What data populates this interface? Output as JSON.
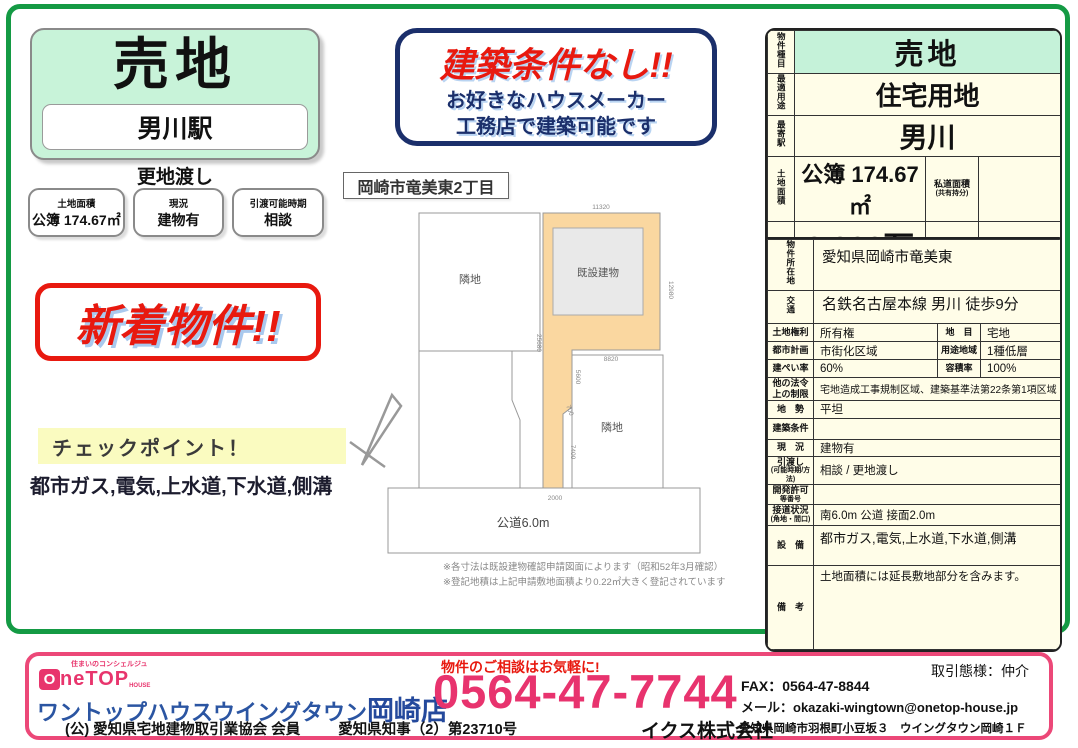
{
  "left_panel": {
    "title": "売地",
    "station": "男川駅",
    "delivery_note": "更地渡し",
    "info_boxes": [
      {
        "label": "土地面積",
        "value": "公簿 174.67㎡"
      },
      {
        "label": "現況",
        "value": "建物有"
      },
      {
        "label": "引渡可能時期",
        "value": "相談"
      }
    ],
    "new_badge": "新着物件!!",
    "checkpoint_title": "チェックポイント！",
    "checkpoint_text": "都市ガス,電気,上水道,下水道,側溝"
  },
  "banner": {
    "headline": "建築条件なし!!",
    "sub1": "お好きなハウスメーカー",
    "sub2": "工務店で建築可能です"
  },
  "site_plan": {
    "title": "岡崎市竜美東2丁目",
    "neighbor_left": "隣地",
    "neighbor_right": "隣地",
    "building": "既設建物",
    "road": "公道6.0m",
    "dim_top": "11320",
    "dim_right": "12980",
    "dim_left": "25680",
    "dim_mid": "8820",
    "dim_inner": "5600",
    "dim_jog": "700",
    "dim_lower": "7400",
    "dim_bottom": "2000",
    "note1": "※各寸法は既設建物確認申請図面によります（昭和52年3月確認）",
    "note2": "※登記地積は上記申請敷地面積より0.22㎡大きく登記されています"
  },
  "summary": {
    "type_label": "物件種目",
    "type_value": "売地",
    "use_label": "最適用途",
    "use_value": "住宅用地",
    "station_label": "最寄駅",
    "station_value": "男川",
    "area_label": "土地面積",
    "area_value": "公簿 174.67㎡",
    "private_road_label_a": "私道面積",
    "private_road_label_b": "(共有持分)",
    "private_road_value": "",
    "price_label": "価格",
    "price_value": "2,200万円",
    "tsubo_label": "坪単価",
    "tsubo_value": "@41.64万円"
  },
  "details": {
    "address_label": "物件所在地",
    "address_value": "愛知県岡崎市竜美東",
    "transport_label": "交通",
    "transport_value": "名鉄名古屋本線 男川 徒歩9分",
    "grid_rows": [
      {
        "l1": "土地権利",
        "v1": "所有権",
        "l2": "地　目",
        "v2": "宅地"
      },
      {
        "l1": "都市計画",
        "v1": "市街化区域",
        "l2": "用途地域",
        "v2": "1種低層"
      },
      {
        "l1": "建ぺい率",
        "v1": "60%",
        "l2": "容積率",
        "v2": "100%"
      }
    ],
    "span_rows": [
      {
        "label_a": "他の法令",
        "label_b": "上の制限",
        "value": "宅地造成工事規制区域、建築基準法第22条第1項区域"
      },
      {
        "label_a": "地　勢",
        "label_b": "",
        "value": "平坦"
      },
      {
        "label_a": "建築条件",
        "label_b": "",
        "value": ""
      },
      {
        "label_a": "現　況",
        "label_b": "",
        "value": "建物有"
      },
      {
        "label_a": "引渡し",
        "label_b": "(可能時期/方法)",
        "value": "相談 / 更地渡し"
      },
      {
        "label_a": "開発許可",
        "label_b": "等番号",
        "value": ""
      },
      {
        "label_a": "接道状況",
        "label_b": "(角地・間口)",
        "value": "南6.0m 公道 接面2.0m"
      },
      {
        "label_a": "設　備",
        "label_b": "",
        "value": "都市ガス,電気,上水道,下水道,側溝"
      },
      {
        "label_a": "備　考",
        "label_b": "",
        "value": "土地面積には延長敷地部分を含みます。"
      }
    ]
  },
  "footer": {
    "logo_tagline": "住まいのコンシェルジュ",
    "logo_o": "O",
    "logo_text": "neTOP",
    "logo_sub": "HOUSE",
    "shop_name": "ワントップハウスウイングタウン",
    "shop_branch": "岡崎店",
    "membership": "(公) 愛知県宅地建物取引業協会 会員",
    "license": "愛知県知事（2）第23710号",
    "contact_note": "物件のご相談はお気軽に!",
    "phone": "0564-47-7744",
    "company": "イクス株式会社",
    "fax": "FAX：0564-47-8844",
    "email": "メール：okazaki-wingtown@onetop-house.jp",
    "deal_type": "取引態様：仲介",
    "address": "愛知県岡崎市羽根町小豆坂３　ウイングタウン岡崎１Ｆ"
  }
}
